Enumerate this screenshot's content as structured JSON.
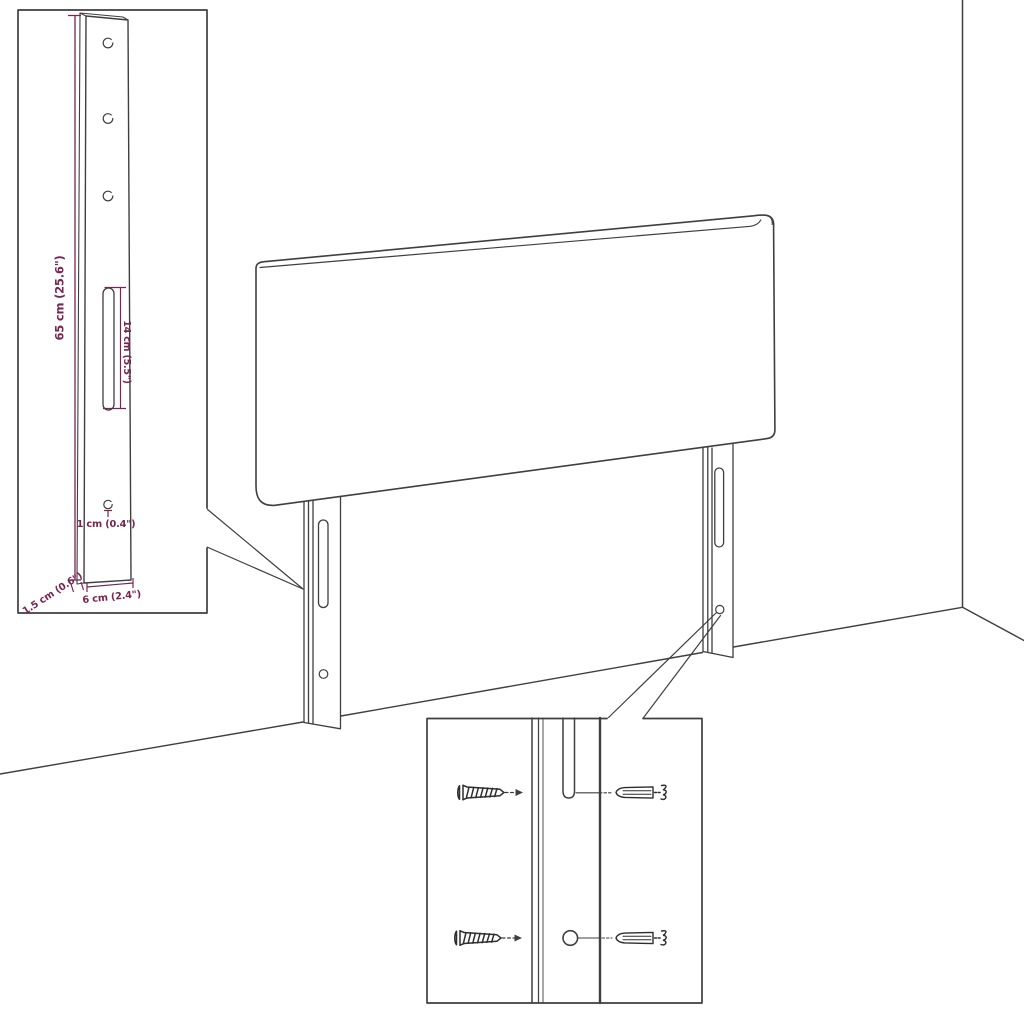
{
  "diagram": {
    "accent_color": "#7b2452",
    "line_color": "#3f3f3f",
    "leg_detail": {
      "height_label": "65 cm (25.6\")",
      "slot_label": "14 cm (5.5\")",
      "hole_label": "1 cm (0.4\")",
      "depth_label": "1.5 cm (0.6\")",
      "width_label": "6 cm (2.4\")"
    }
  }
}
